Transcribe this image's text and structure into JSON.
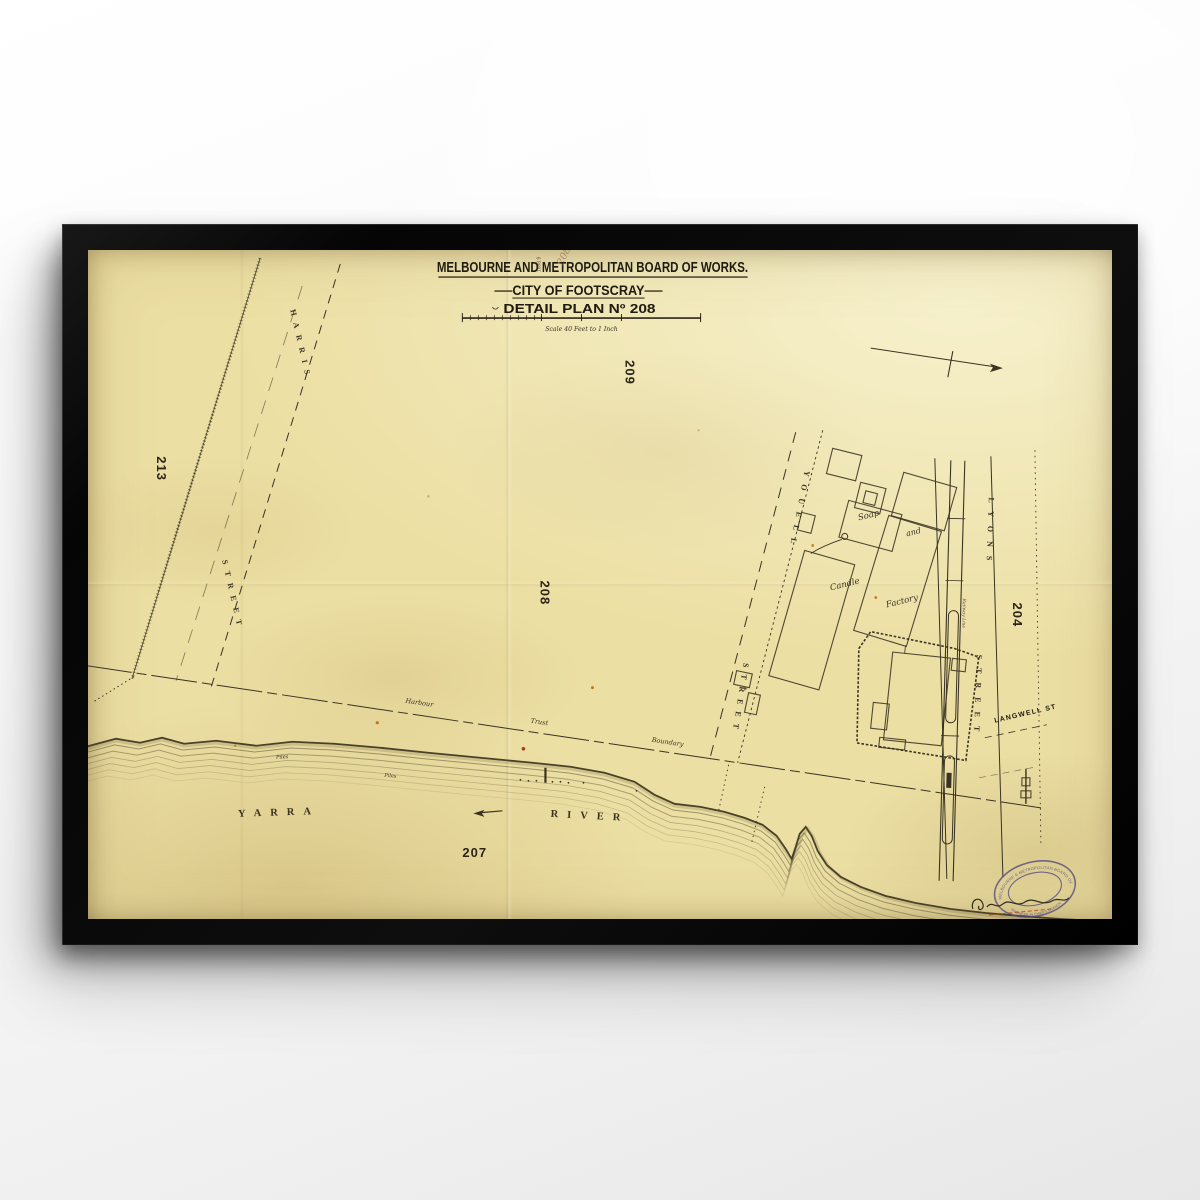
{
  "artwork": {
    "board": "MELBOURNE AND METROPOLITAN BOARD OF WORKS.",
    "city": "CITY OF FOOTSCRAY",
    "plan": "DETAIL PLAN Nº 208",
    "scale_caption": "Scale 40 Feet to 1 Inch",
    "top_note": "1898.9",
    "top_note_hand": "208"
  },
  "map": {
    "adjacent_plans": {
      "left": "213",
      "top": "209",
      "center": "208",
      "right": "204",
      "bottom": "207"
    },
    "streets": {
      "harris_line1": "HARRIS",
      "harris_line2": "STREET",
      "youell_line1": "YOUELL",
      "youell_line2": "STREET",
      "lyons_line1": "LYONS",
      "lyons_line2": "STREET",
      "langwell": "LANGWELL ST"
    },
    "river": {
      "name_word1": "YARRA",
      "name_word2": "RIVER",
      "piles": "Piles"
    },
    "boundary": {
      "word1": "Harbour",
      "word2": "Trust",
      "word3": "Boundary"
    },
    "factory": {
      "word1": "Soap",
      "word2": "and",
      "word3": "Candle",
      "word4": "Factory"
    },
    "railway_note": "Railway Line"
  },
  "stamp": {
    "arc_top": "MELBOURNE & METROPOLITAN BOARD OF WORKS",
    "arc_bottom": "ENGINEER IN CHIEF'S BRANCH"
  },
  "colors": {
    "paper": "#ecdfa3",
    "ink": "#3a3322",
    "title_ink": "#201b10",
    "stamp_purple": "#564a80",
    "red": "#b5451f",
    "frame": "#0c0c0c"
  }
}
